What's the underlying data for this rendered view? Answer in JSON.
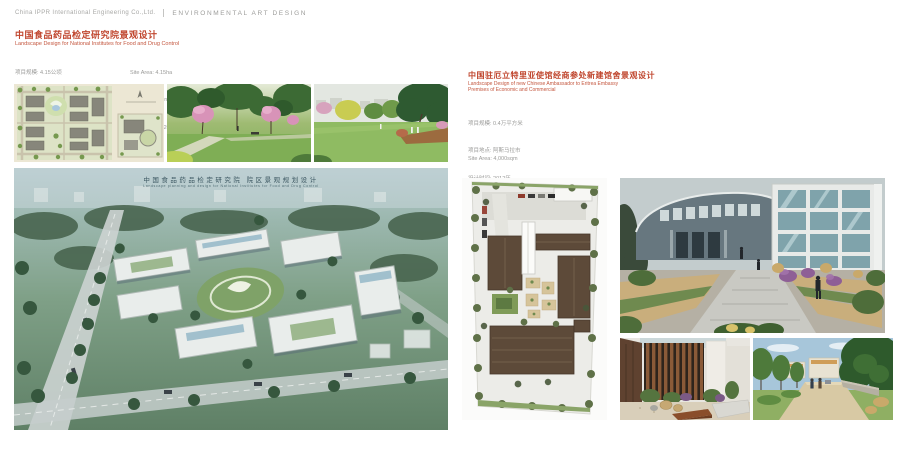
{
  "header": {
    "company": "China IPPR International Engineering Co.,Ltd.",
    "section": "ENVIRONMENTAL ART DESIGN"
  },
  "colors": {
    "accent_red": "#c0462e",
    "meta_gray": "#9b9b99",
    "header_gray": "#a8a8a6"
  },
  "project_left": {
    "title_zh": "中国食品药品检定研究院景观设计",
    "title_en": "Landscape Design for National Institutes for Food and Drug Control",
    "meta_zh": [
      "项目规模: 4.15公顷",
      "项目地点: 北京",
      "设计时间: 2011"
    ],
    "meta_en": [
      "Site Area: 4.15ha",
      "Location: Beijing",
      "Design Time: 2011"
    ],
    "aerial_overlay": {
      "zh": "中国食品药品检定研究院 院区景观规划设计",
      "en": "Landscape planning and design for National Institutes for Food and Drug Control"
    }
  },
  "project_right": {
    "title_zh": "中国驻厄立特里亚使馆经商参处新建馆舍景观设计",
    "title_en": [
      "Landscape Design of new Chinese Ambassador to Eritrea Embassy",
      "Premises of Economic and Commercial"
    ],
    "meta_zh": [
      "项目规模: 0.4万平方米",
      "项目地点: 阿斯马拉市",
      "设计时间: 2012年",
      "竣工时间: 2013 年"
    ],
    "meta_en": [
      "Site Area: 4,000sqm",
      "Location: Eritrea",
      "Design Time: 2012",
      "Completion Time: 2013"
    ]
  }
}
